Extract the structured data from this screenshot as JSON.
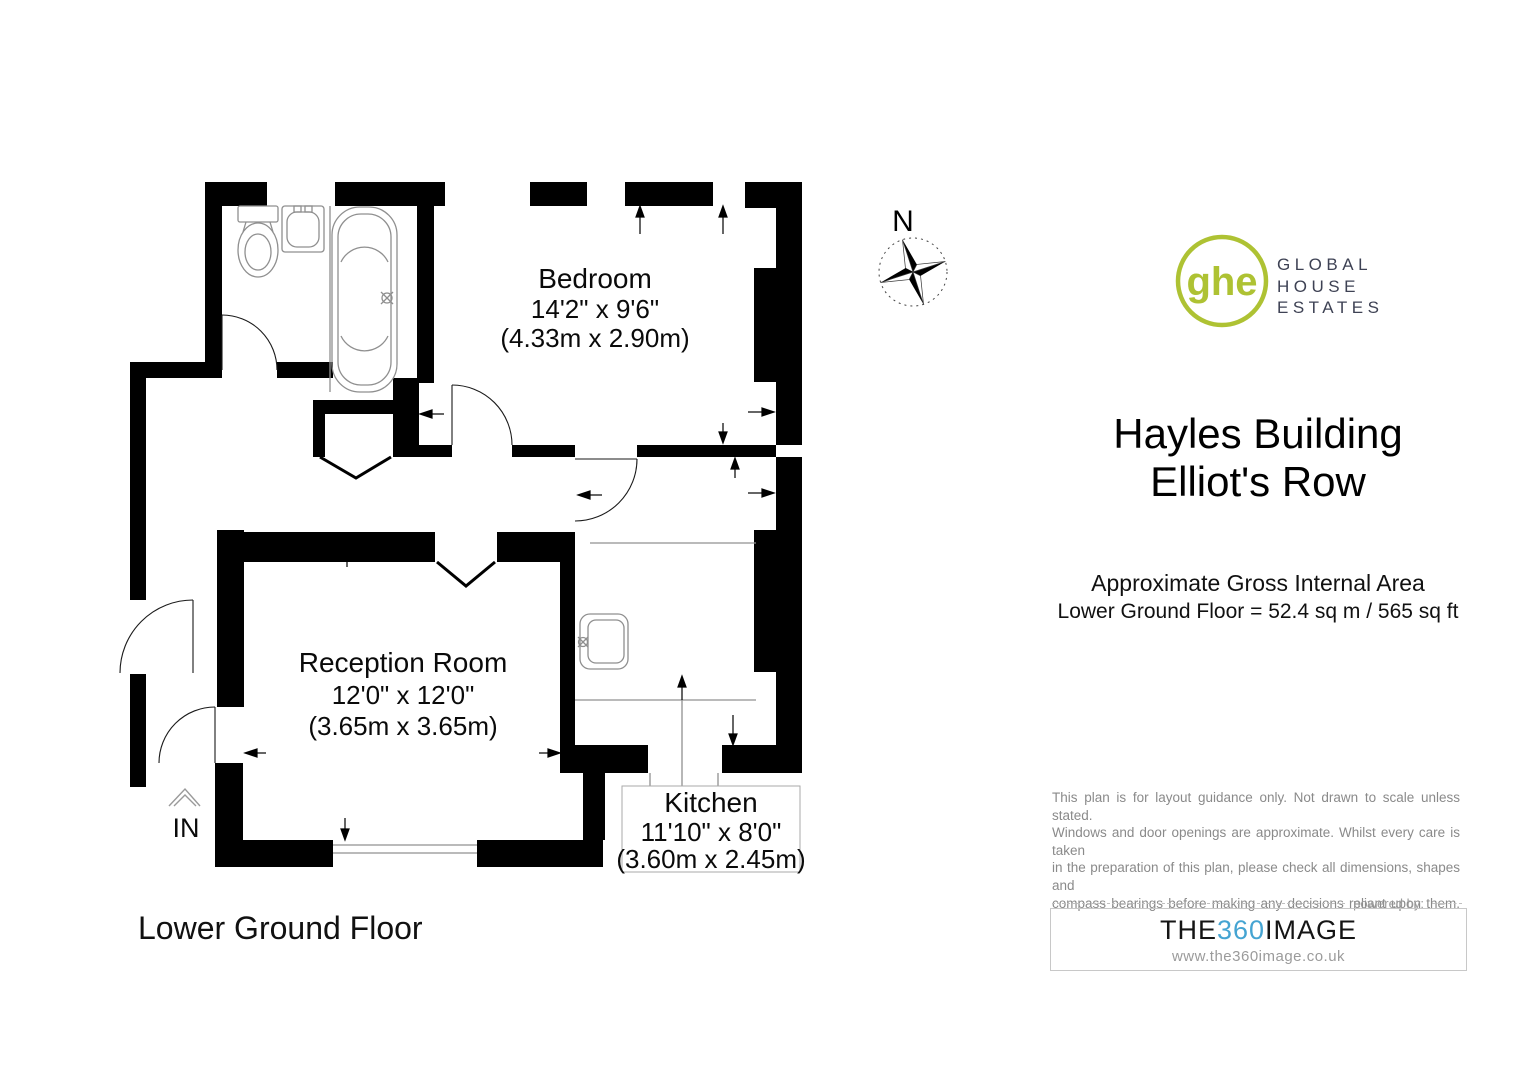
{
  "plan": {
    "floor_label": "Lower Ground Floor",
    "entrance_label": "IN",
    "compass_label": "N",
    "wall_color": "#000000",
    "fixture_line_color": "#8f8f8f",
    "rooms": [
      {
        "name": "Bedroom",
        "dims_imperial": "14'2\" x 9'6\"",
        "dims_metric": "(4.33m x 2.90m)"
      },
      {
        "name": "Reception Room",
        "dims_imperial": "12'0\" x 12'0\"",
        "dims_metric": "(3.65m x 3.65m)"
      },
      {
        "name": "Kitchen",
        "dims_imperial": "11'10\" x 8'0\"",
        "dims_metric": "(3.60m x 2.45m)"
      }
    ]
  },
  "branding": {
    "logo_monogram": "ghe",
    "logo_name_line1": "GLOBAL",
    "logo_name_line2": "HOUSE",
    "logo_name_line3": "ESTATES",
    "logo_green": "#aec233",
    "logo_navy": "#3e4254"
  },
  "property": {
    "title_line1": "Hayles Building",
    "title_line2": "Elliot's Row"
  },
  "area": {
    "heading": "Approximate Gross Internal Area",
    "detail": "Lower Ground Floor = 52.4 sq m / 565 sq ft"
  },
  "disclaimer": {
    "line1": "This plan is for layout guidance only. Not drawn to scale unless stated.",
    "line2": "Windows and door openings are approximate. Whilst every care is taken",
    "line3": "in the preparation of this plan, please check all dimensions, shapes and",
    "line4": "compass bearings before making any decisions reliant upon them."
  },
  "powered_by": {
    "label": "powered by:",
    "brand_prefix": "THE",
    "brand_number": "360",
    "brand_suffix": "IMAGE",
    "accent_blue": "#45a4d2",
    "url": "www.the360image.co.uk"
  }
}
